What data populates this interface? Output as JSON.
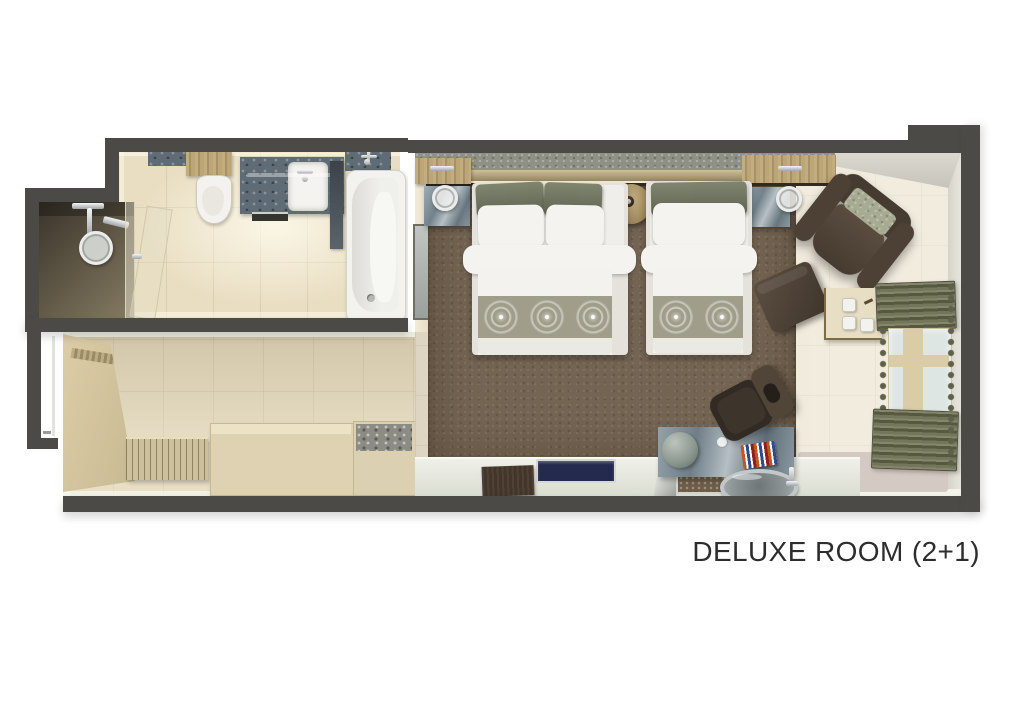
{
  "caption": "DELUXE ROOM (2+1)",
  "palette": {
    "wall": "#4b4a47",
    "floorBath": "#e9dec2",
    "floorHall": "#e0d5b8",
    "floorBedroom": "#e9e1cf",
    "carpet": "#746452",
    "runner": "#a09e8a",
    "linen": "#f2f1ed",
    "pillowOlive": "#767b68",
    "marble": "#7e8c96",
    "granite": "#5f6c76",
    "wood": "#b49e74",
    "curtain": "#6b6d52",
    "chairBrown": "#4a3e33",
    "windowGlass": "#dde6e2",
    "text": "#2d2d2d"
  },
  "rooms": [
    "bathroom",
    "shower",
    "entry-hall",
    "bedroom"
  ],
  "fixtures": [
    "shower-head",
    "glass-partition",
    "toilet",
    "vanity-sink",
    "bathtub",
    "entry-door",
    "radiator-bench",
    "luggage-bench",
    "minibar",
    "double-bed",
    "single-bed",
    "bedside-round-table",
    "nightstand",
    "wall-lamp",
    "mirror",
    "armchair",
    "ottoman",
    "coffee-table",
    "curtains",
    "window",
    "desk-console",
    "desk-chair",
    "washbasin-bowl",
    "decor-panel"
  ]
}
